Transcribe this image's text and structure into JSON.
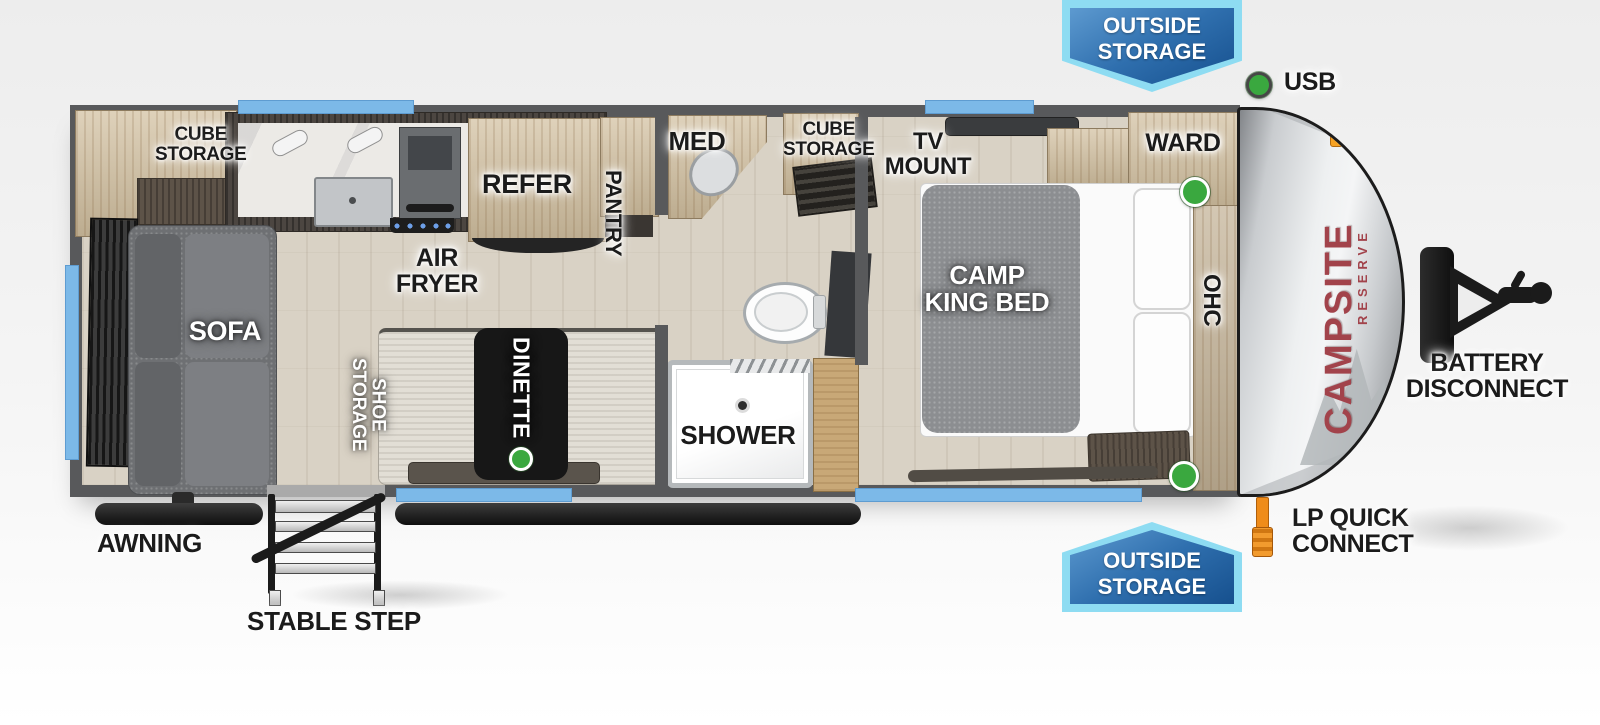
{
  "banners": {
    "outside_storage_top": "OUTSIDE\nSTORAGE",
    "outside_storage_bottom": "OUTSIDE\nSTORAGE"
  },
  "callouts": {
    "usb": "USB",
    "battery_disconnect": "BATTERY\nDISCONNECT",
    "lp_quick_connect": "LP QUICK\nCONNECT",
    "awning": "AWNING",
    "stable_step": "STABLE STEP"
  },
  "brand": {
    "name": "CAMPSITE",
    "series": "RESERVE"
  },
  "living_area": {
    "cube_storage": "CUBE\nSTORAGE",
    "sofa": "SOFA",
    "air_fryer": "AIR\nFRYER",
    "refer": "REFER",
    "pantry": "PANTRY",
    "shoe_storage": "SHOE STORAGE",
    "dinette": "DINETTE"
  },
  "bathroom": {
    "med": "MED",
    "cube_storage": "CUBE\nSTORAGE",
    "shower": "SHOWER"
  },
  "bedroom": {
    "tv_mount": "TV\nMOUNT",
    "ward": "WARD",
    "camp_king_bed": "CAMP\nKING BED",
    "ohc": "OHC"
  },
  "colors": {
    "wall": "#58595b",
    "banner_blue": "#2f6fae",
    "banner_border": "#8edcf2",
    "window_blue": "#7cb9e8",
    "usb_green": "#3aa83f",
    "marker_orange": "#f59b23",
    "logo_red": "#a2434b"
  }
}
